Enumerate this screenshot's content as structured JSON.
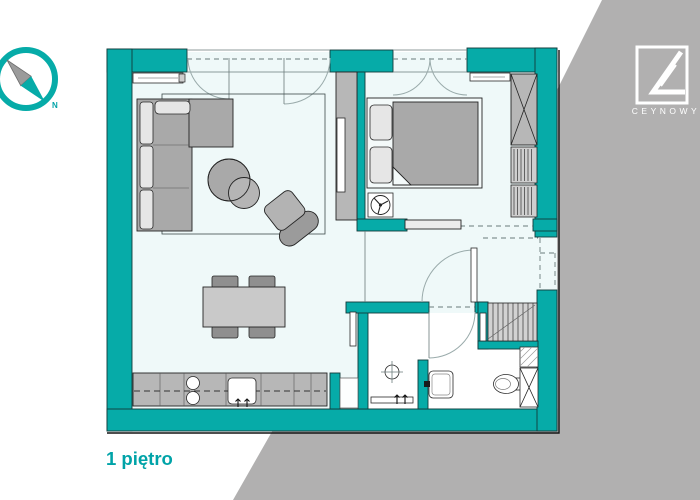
{
  "labels": {
    "floor_title": "1 piętro",
    "brand": "CEYNOWY",
    "compass_north": "N"
  },
  "colors": {
    "teal": "#06aba8",
    "accent_text": "#00a3a8",
    "background_gray": "#b1b0b0",
    "floor": "#eff9f9",
    "furniture_gray": "#a9a9a9",
    "furniture_light": "#e6e6e6",
    "counter_gray": "#b7b7b7",
    "logo_white": "#ffffff"
  },
  "plan": {
    "elements": [
      "exterior-walls",
      "french-doors",
      "bedroom-window",
      "sofa",
      "rug",
      "coffee-tables",
      "armchair",
      "tv-cabinet",
      "radiator",
      "dining-table",
      "dining-chairs",
      "kitchen-counter",
      "hob-burners",
      "kitchen-sink",
      "bed",
      "pillows",
      "ceiling-fan-symbol",
      "wardrobe",
      "shelf",
      "sliding-door",
      "entry-door",
      "entrance-recess",
      "stairs",
      "bathroom-door",
      "shower-drain",
      "shower-channel",
      "washbasin",
      "toilet",
      "bathroom-cabinet",
      "water-heater-hatch"
    ]
  }
}
